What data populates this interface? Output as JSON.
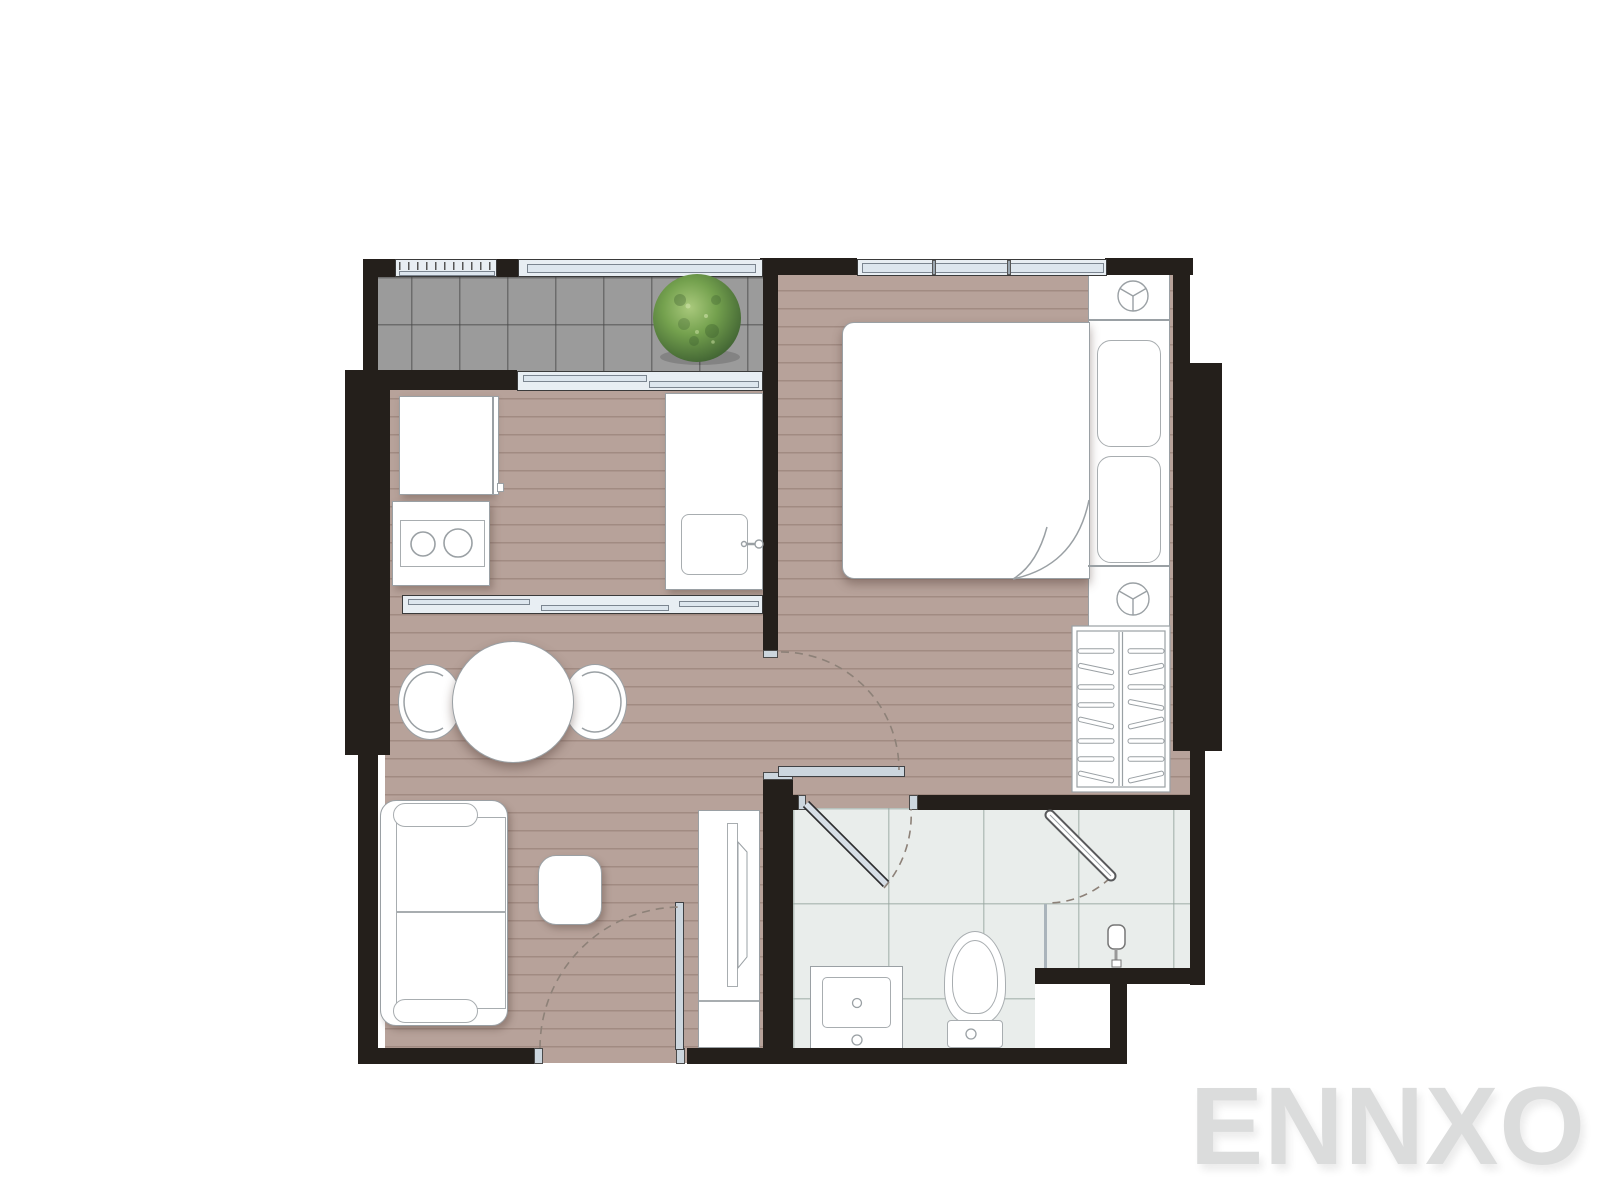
{
  "watermark": {
    "text": "ENNXO",
    "color": "#dbdcdc"
  },
  "palette": {
    "wall": "#241f1b",
    "wood_floor": "#b7a29a",
    "wood_plank_line": "#6e554b",
    "balcony_tile": "#9b9b9b",
    "bathroom_tile": "#e9edeb",
    "glass_fill": "#e8eef3",
    "door_leaf": "#ccd6de",
    "furniture_outline": "#9aa0a4",
    "swing_arc": "#8d8178",
    "plant_green": "#4a6f38"
  },
  "elements": {
    "rooms": [
      "balcony",
      "kitchen",
      "living-dining",
      "bedroom",
      "bathroom",
      "shower"
    ],
    "balcony": [
      "railing",
      "planter-bush",
      "sliding-glass-door"
    ],
    "kitchen": [
      "refrigerator",
      "stove-two-burners",
      "counter-with-sink",
      "glass-partition"
    ],
    "living_dining": [
      "round-dining-table",
      "two-chairs",
      "sofa",
      "coffee-table",
      "tv-cabinet",
      "entrance-door"
    ],
    "bedroom": [
      "double-bed-folded-sheet",
      "two-pillows",
      "headboard-platform",
      "two-nightstand-lamps",
      "wardrobe-with-hangers",
      "window"
    ],
    "bathroom": [
      "vanity-sink",
      "toilet",
      "shower-glass-partition",
      "shower-door",
      "shower-head",
      "swing-door"
    ]
  }
}
